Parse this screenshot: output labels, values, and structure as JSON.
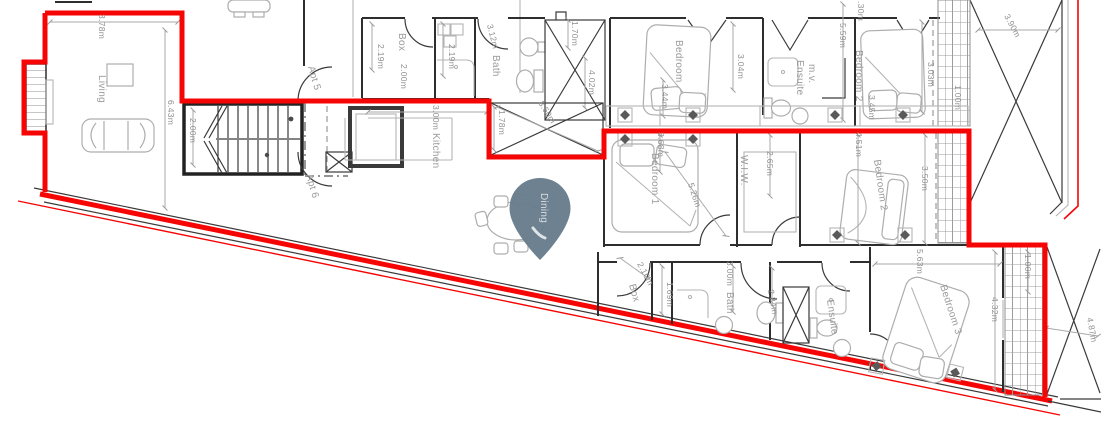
{
  "plan": {
    "boundary_color": "#f60505",
    "marker": {
      "label": "Dining",
      "color": "#677c8b"
    },
    "apartments": {
      "apt5": "Apt 5",
      "apt6": "Apt 6"
    },
    "rooms": {
      "living": "Living",
      "kitchen": "Kitchen",
      "box_top": "Box",
      "bath_top": "Bath",
      "bedroom_top": "Bedroom",
      "ensuite_mv_1": "Ensuite",
      "ensuite_mv_2": "m.v.",
      "bedroom2_top": "Bedroom 2",
      "bedroom1": "Bedroom 1",
      "wiw": "W.I.W.",
      "bedroom2": "Bedroom 2",
      "box_bottom": "Box",
      "bath_bottom": "Bath",
      "ensuite_bottom": "Ensuite",
      "bedroom3": "Bedroom 3"
    },
    "dims": {
      "living_w": "3.78m",
      "living_h": "6.43m",
      "stairs": "2.00m",
      "box_d": "2.19m",
      "box_w": "2.00m",
      "util": "2.19m",
      "bath_top": "3.12m",
      "void_top": "1.70m",
      "void_h": "4.02m",
      "void_diag": "3.50m",
      "void_w": "1.78m",
      "kitchen": "3.00m",
      "bedroom_top": "3.04m",
      "bed_top": "3.44m",
      "ensuite_mv": "5.59m",
      "top_cut": ".30m",
      "bedroom2_top": "3.45m",
      "balcony_top_h": "3.03m",
      "balcony_top_w": "1.00m",
      "site_top": "3.90m",
      "bedroom2_l": "4.51m",
      "bedroom2_w": "3.50m",
      "bedroom1_w": "3.68m",
      "bedroom1_diag": "5.26m",
      "wiw": "2.65m",
      "corridor": "5.63m",
      "box_b": "2.10m",
      "box_b_w": "1.69m",
      "bath_b": "3.00m",
      "bath_b_w": "2.34m",
      "bedroom3": "4.32m",
      "balcony_b_w": "1.00m",
      "site_right": "4.87m"
    }
  }
}
